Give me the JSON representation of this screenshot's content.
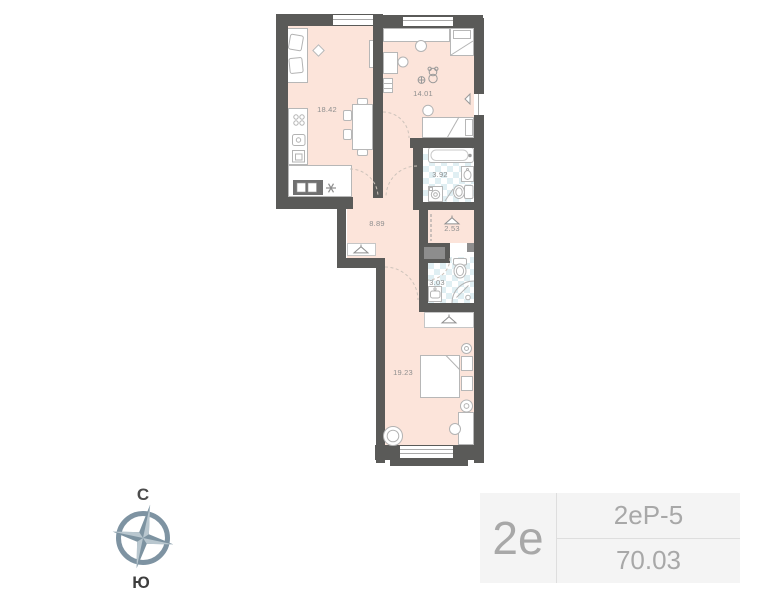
{
  "plan": {
    "rooms": [
      {
        "name": "living-kitchen",
        "area": "18.42"
      },
      {
        "name": "bedroom-children",
        "area": "14.01"
      },
      {
        "name": "bathroom",
        "area": "3.92"
      },
      {
        "name": "wardrobe",
        "area": "2.53"
      },
      {
        "name": "hallway",
        "area": "8.89"
      },
      {
        "name": "shower-room",
        "area": "3.03"
      },
      {
        "name": "bedroom-master",
        "area": "19.23"
      }
    ],
    "colors": {
      "wall": "#5a5a58",
      "room_fill": "#fce4da",
      "tile_accent": "#e0eff3",
      "label_text": "#8f8f8f",
      "compass_steel": "#7d93a1",
      "compass_light": "#b9c7cf",
      "badge_bg": "#f4f4f4",
      "badge_text": "#a8a8a8"
    },
    "icons": [
      "clothes-hanger",
      "snowflake-fridge",
      "teddy-bear",
      "ball",
      "compass-rose"
    ]
  },
  "compass": {
    "north_label": "С",
    "south_label": "Ю"
  },
  "badge": {
    "type": "2е",
    "layout": "2еР-5",
    "total_area": "70.03"
  }
}
